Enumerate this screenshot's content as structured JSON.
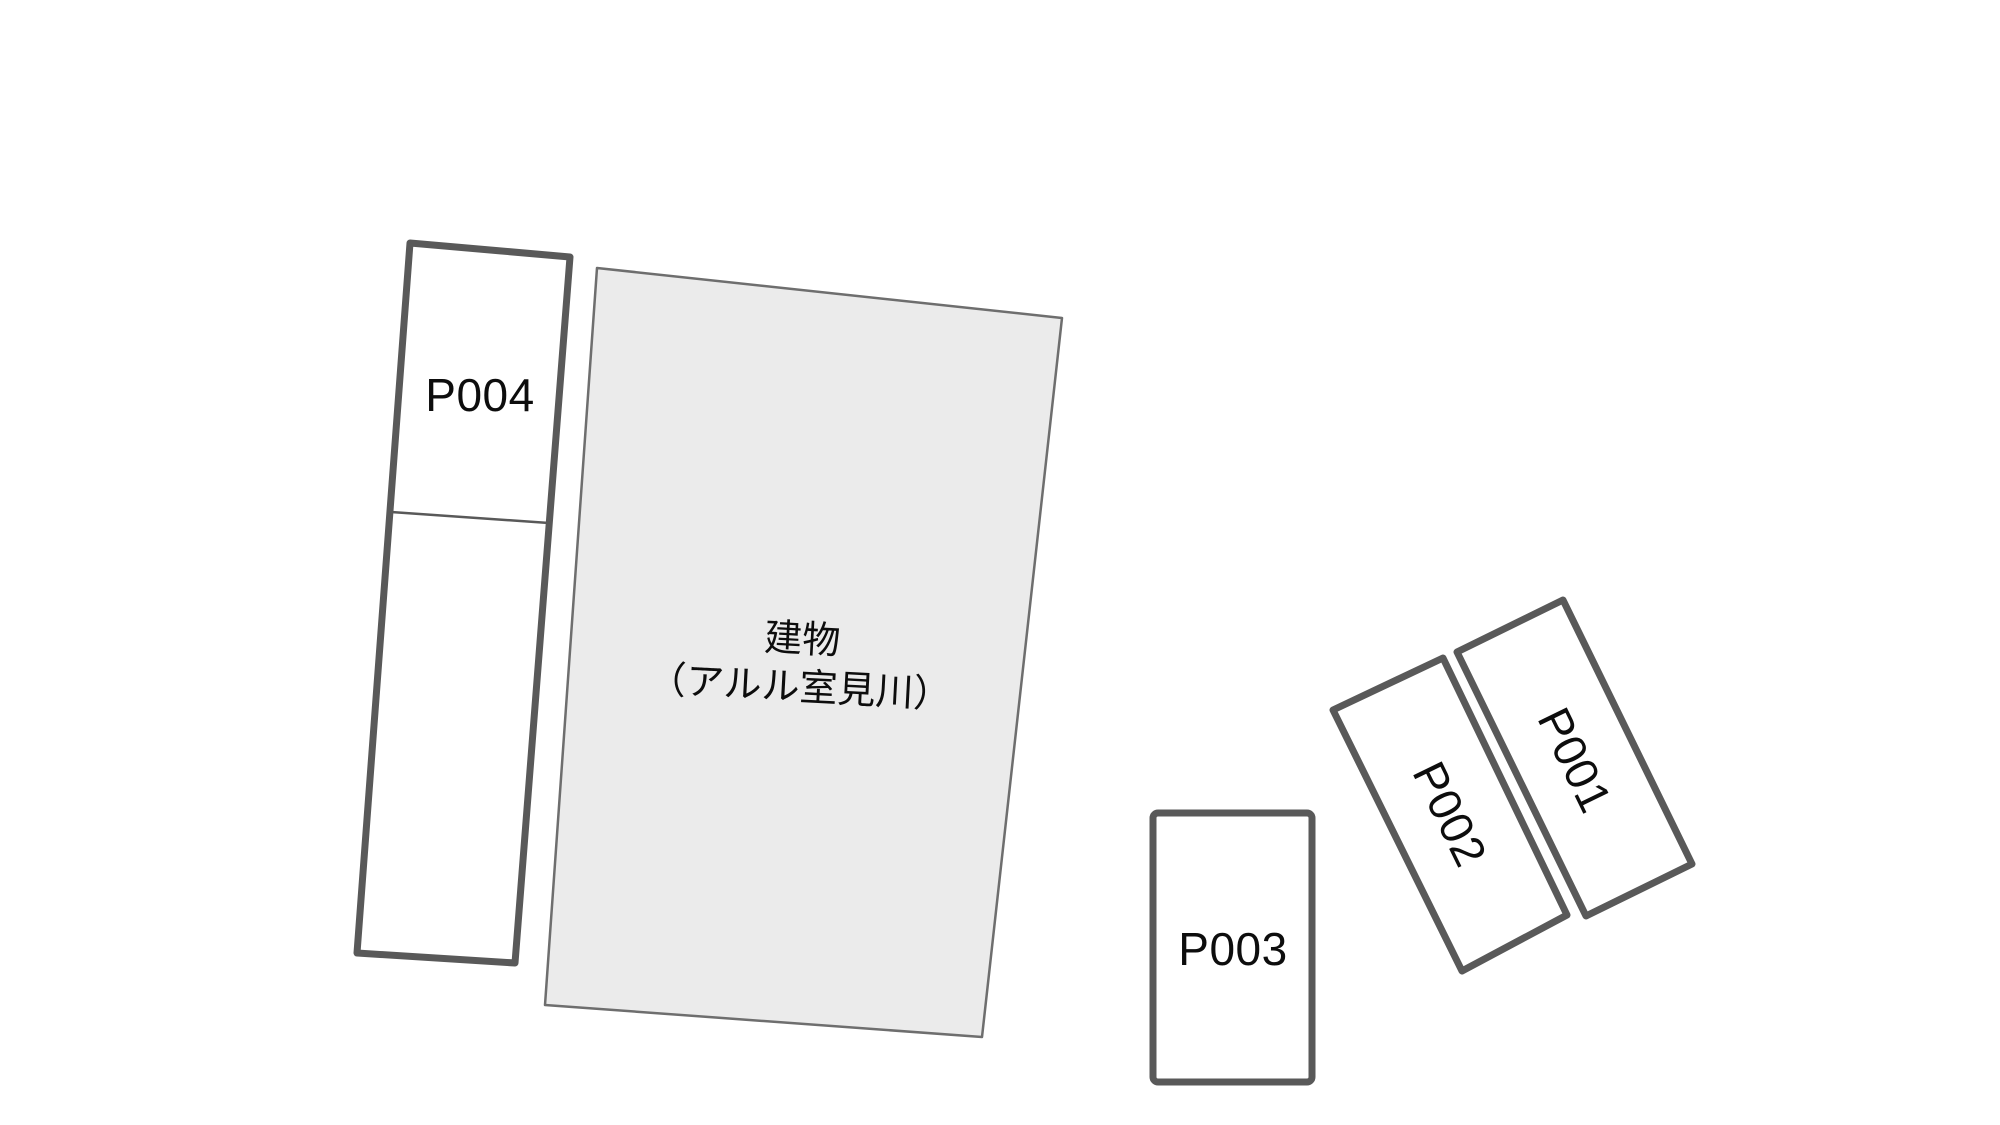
{
  "canvas": {
    "background_color": "#ffffff",
    "width_px": 2000,
    "height_px": 1125
  },
  "colors": {
    "space_border": "#595959",
    "space_fill": "#ffffff",
    "building_fill": "#ebebeb",
    "building_border": "#6e6e6e",
    "label_text": "#0d0d0d"
  },
  "building": {
    "label_line1": "建物",
    "label_line2": "（アルル室見川）"
  },
  "spaces": [
    {
      "id": "P001",
      "label": "P001"
    },
    {
      "id": "P002",
      "label": "P002"
    },
    {
      "id": "P003",
      "label": "P003"
    },
    {
      "id": "P004",
      "label": "P004"
    }
  ]
}
